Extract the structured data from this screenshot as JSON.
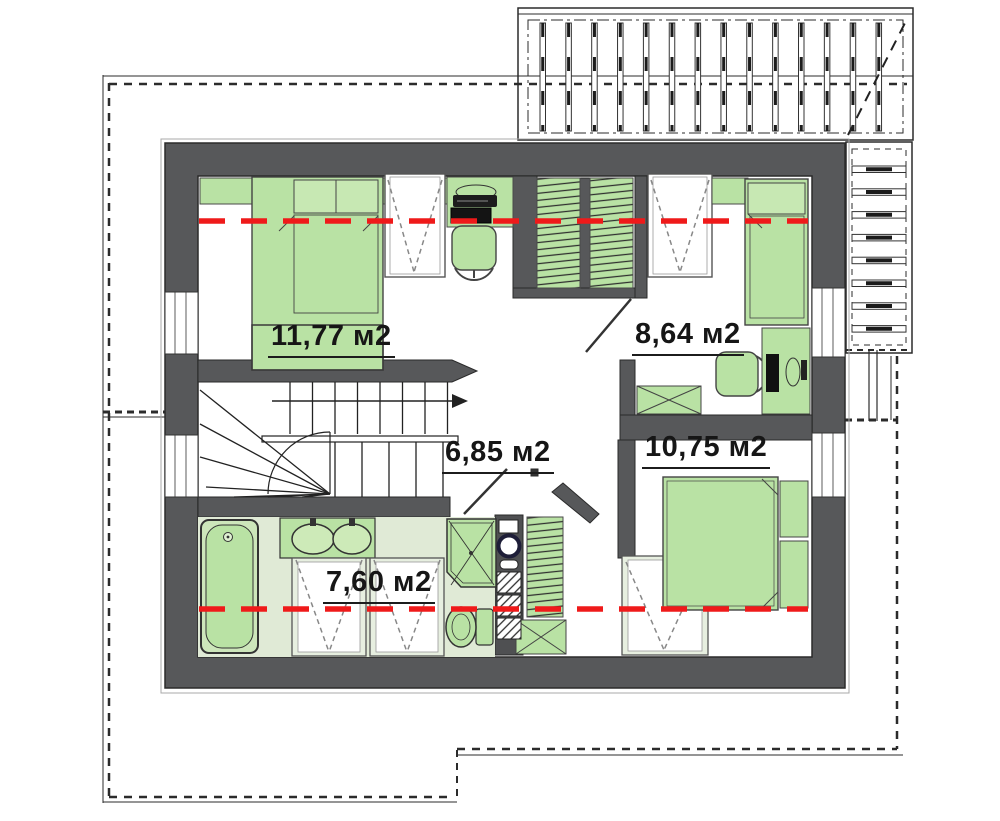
{
  "plan": {
    "rooms": [
      {
        "name": "bedroom-top-left",
        "area_label": "11,77 м2"
      },
      {
        "name": "bedroom-top-right",
        "area_label": "8,64 м2"
      },
      {
        "name": "hallway",
        "area_label": "6,85 м2"
      },
      {
        "name": "bedroom-bottom-right",
        "area_label": "10,75 м2"
      },
      {
        "name": "bathroom",
        "area_label": "7,60 м2"
      }
    ],
    "colors": {
      "wall": "#57585a",
      "furniture_green": "#b9e2a4",
      "furniture_green_light": "#c7e8b3",
      "bathroom_floor_tint": "#e0ead6",
      "roof_window_fill": "#e7efe0",
      "section_line_red": "#ef1a1a",
      "drawing_line": "#2b2b2b"
    }
  }
}
